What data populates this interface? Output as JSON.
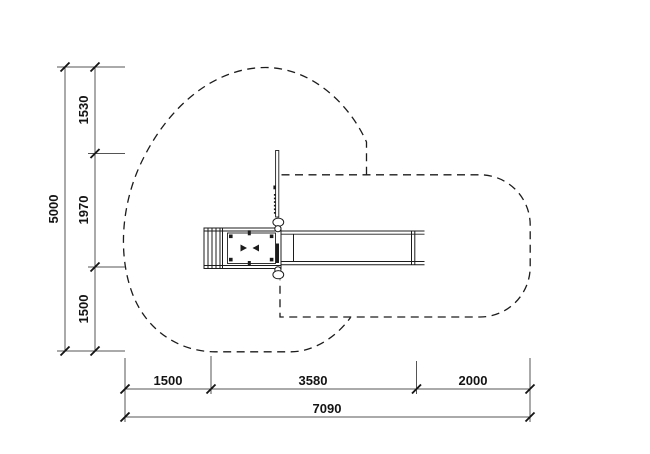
{
  "dimensions": {
    "vertical": {
      "total": "5000",
      "segments": [
        "1530",
        "1970",
        "1500"
      ]
    },
    "horizontal": {
      "total": "7090",
      "segments": [
        "1500",
        "3580",
        "2000"
      ]
    }
  },
  "colors": {
    "background": "#ffffff",
    "line": "#1c1c1c",
    "dimension": "#555555",
    "text": "#141414"
  }
}
